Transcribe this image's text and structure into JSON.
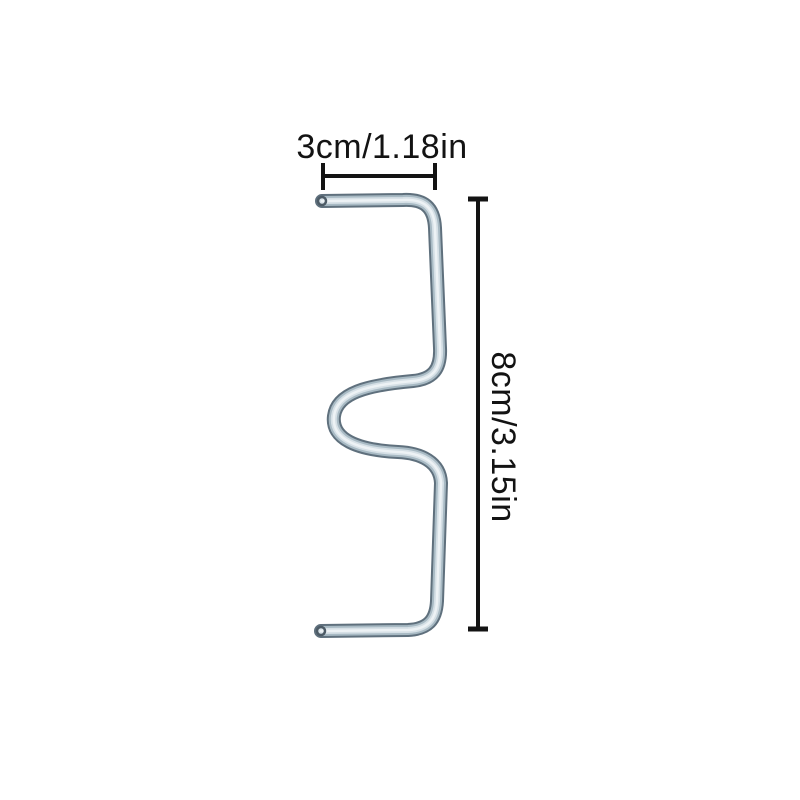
{
  "figure": {
    "description": "metal wire clip product dimension diagram",
    "width_label": "3cm/1.18in",
    "height_label": "8cm/3.15in"
  },
  "colors": {
    "background": "#ffffff",
    "annotation": "#131313",
    "wire_outline": "#5f707d",
    "wire_mid": "#a8bac4",
    "wire_light": "#d6e0e6",
    "wire_highlight": "#edf2f5",
    "wire_tip_ring": "#4d5b66",
    "wire_tip_face": "#cfd9df"
  }
}
